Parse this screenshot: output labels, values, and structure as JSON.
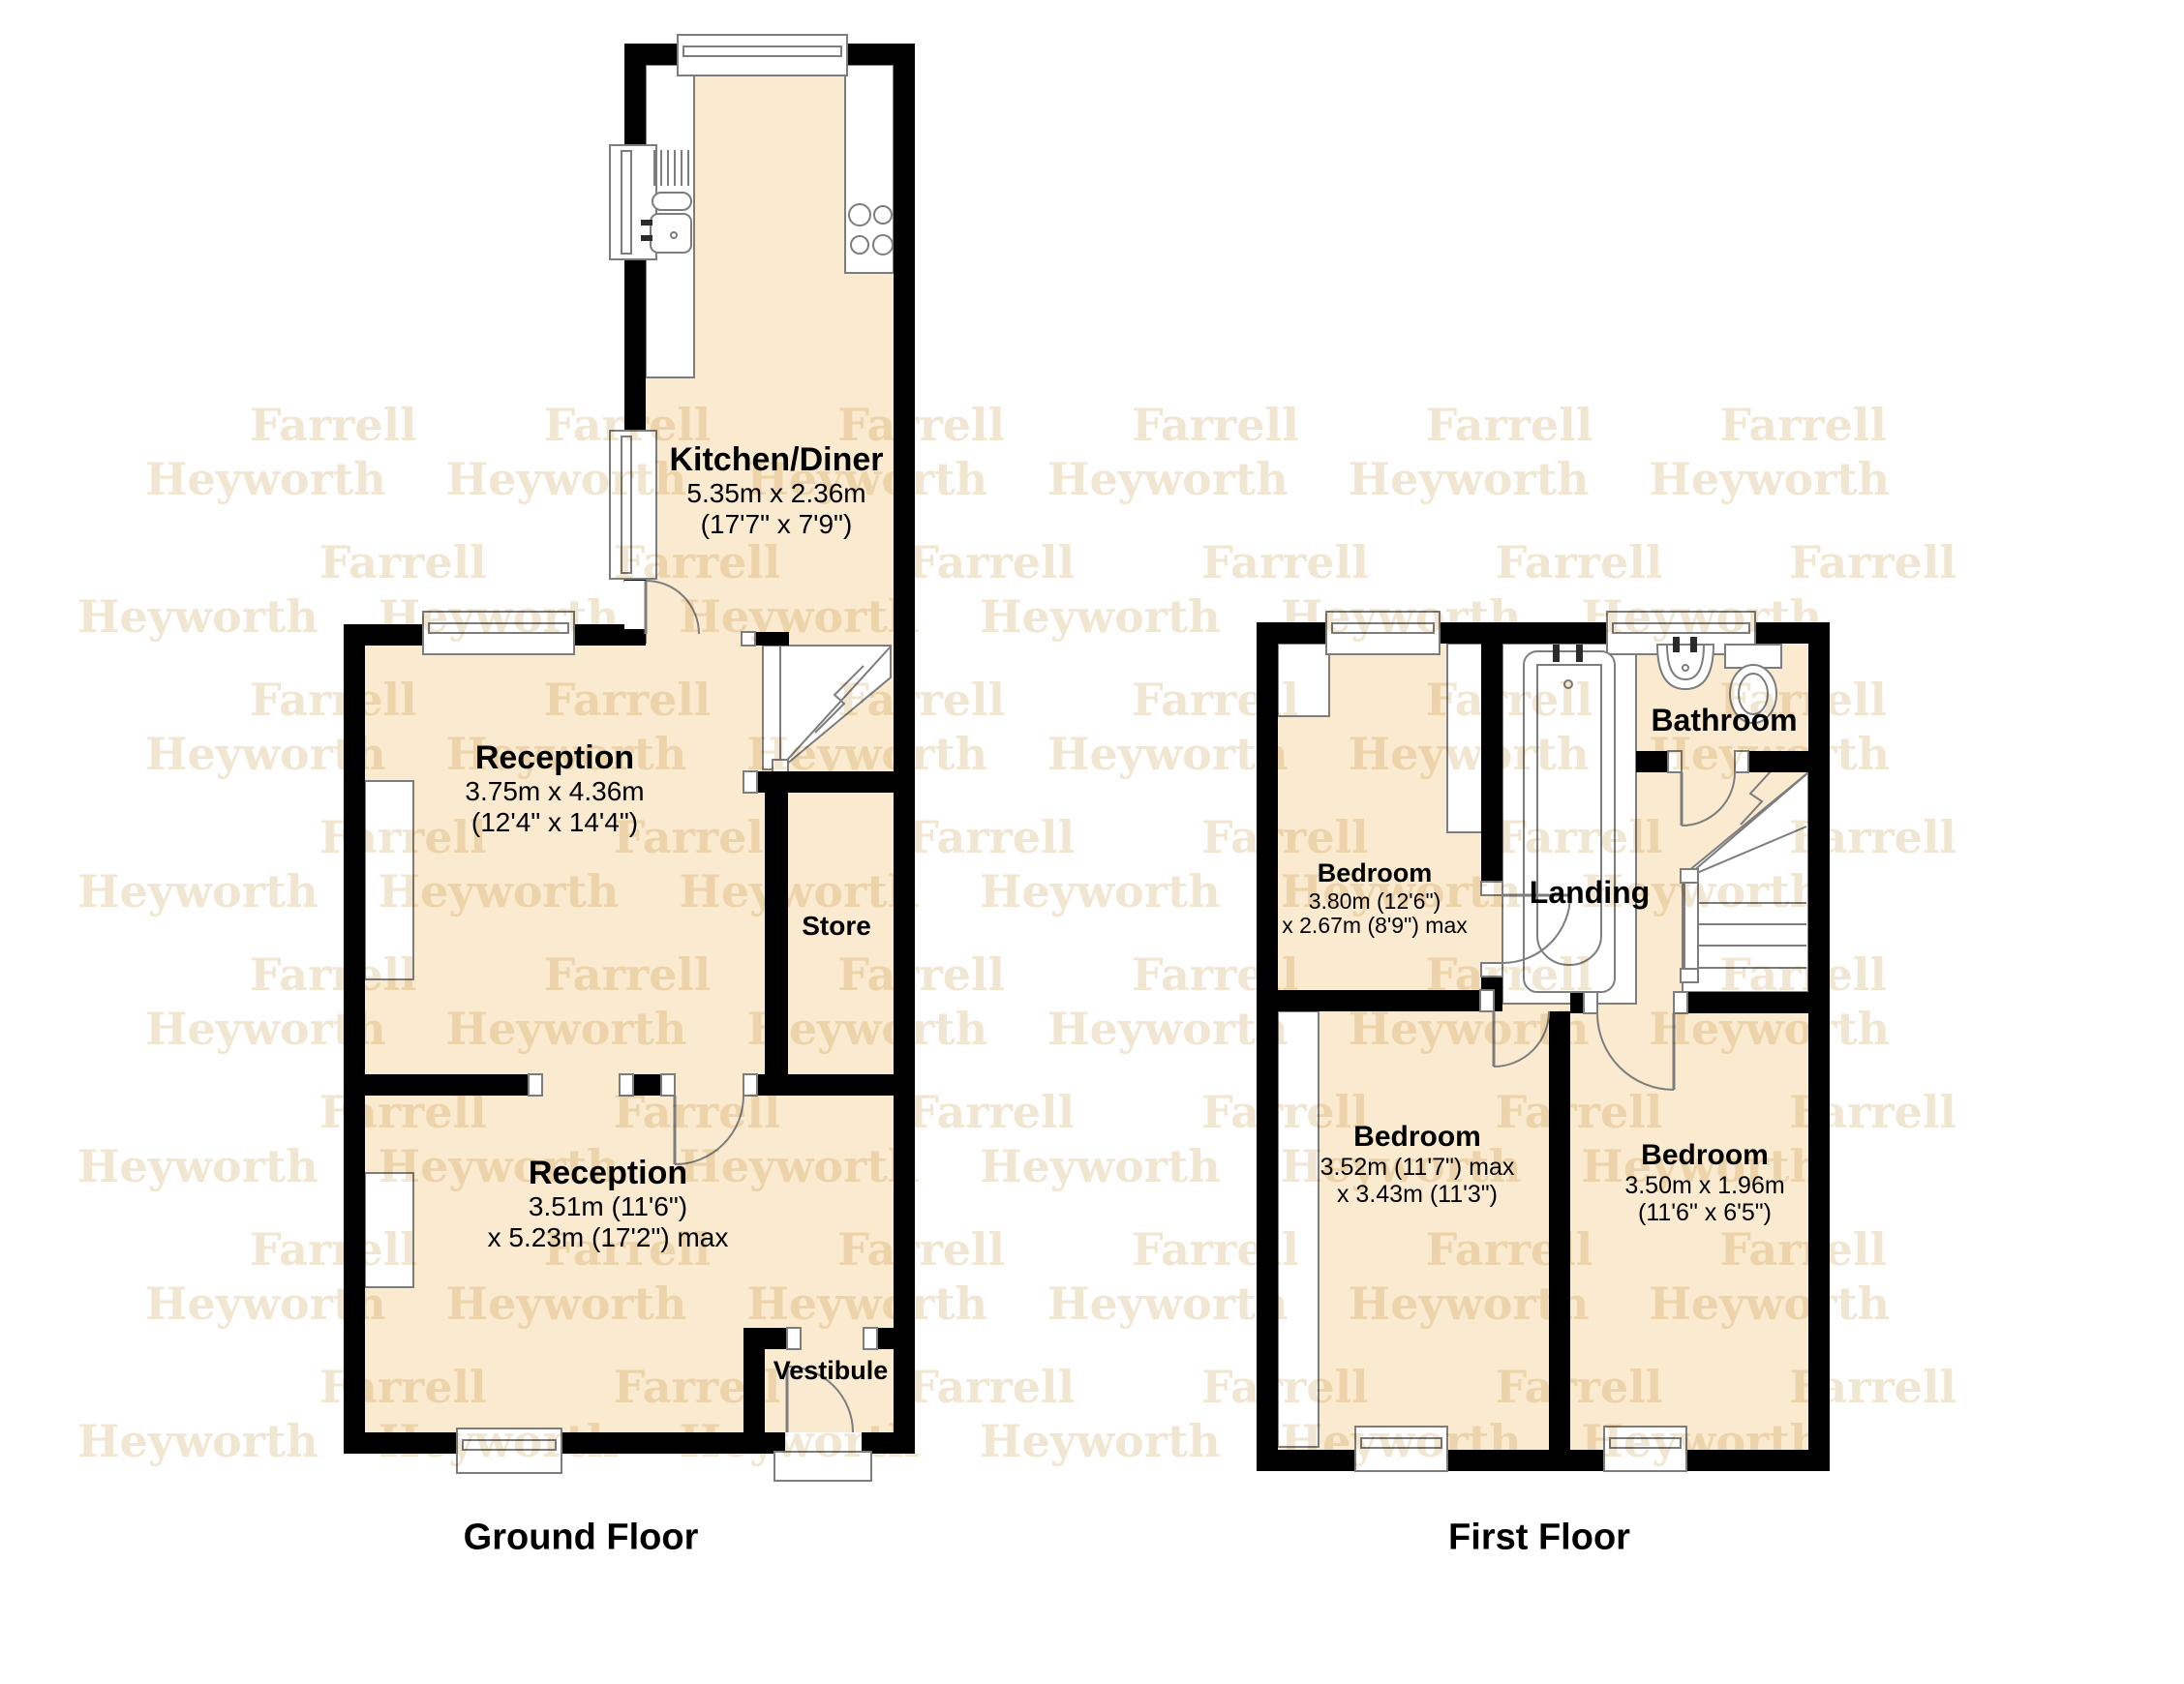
{
  "colors": {
    "floor": "#faeacf",
    "wall": "#000000",
    "fixture": "#7d7d7d",
    "watermark": "#e8d7b4",
    "label": "#000000"
  },
  "watermark": {
    "farrell": "Farrell Farrell Farrell Farrell Farrell Farrell",
    "heyworth": "Heyworth Heyworth Heyworth Heyworth Heyworth Heyworth"
  },
  "ground_floor": {
    "title": "Ground Floor",
    "rooms": {
      "kitchen": {
        "name": "Kitchen/Diner",
        "dims_line1": "5.35m x 2.36m",
        "dims_line2": "(17'7\" x 7'9\")"
      },
      "reception1": {
        "name": "Reception",
        "dims_line1": "3.75m x 4.36m",
        "dims_line2": "(12'4\" x 14'4\")"
      },
      "store": {
        "name": "Store"
      },
      "reception2": {
        "name": "Reception",
        "dims_line1": "3.51m (11'6\")",
        "dims_line2": "x 5.23m (17'2\") max"
      },
      "vestibule": {
        "name": "Vestibule"
      }
    }
  },
  "first_floor": {
    "title": "First Floor",
    "rooms": {
      "bathroom": {
        "name": "Bathroom"
      },
      "bedroom_front": {
        "name": "Bedroom",
        "dims_line1": "3.80m (12'6\")",
        "dims_line2": "x 2.67m (8'9\") max"
      },
      "landing": {
        "name": "Landing"
      },
      "bedroom_middle": {
        "name": "Bedroom",
        "dims_line1": "3.52m (11'7\") max",
        "dims_line2": "x 3.43m (11'3\")"
      },
      "bedroom_back": {
        "name": "Bedroom",
        "dims_line1": "3.50m x 1.96m",
        "dims_line2": "(11'6\" x 6'5\")"
      }
    }
  }
}
